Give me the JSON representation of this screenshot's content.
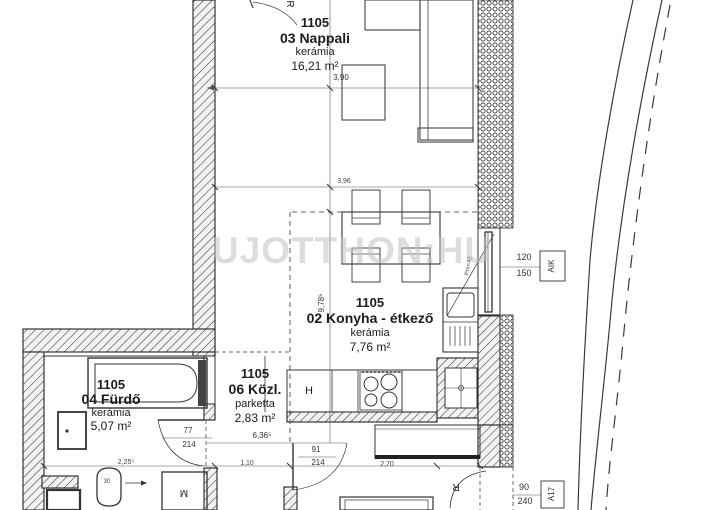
{
  "watermark": "UJOTTHON:HU",
  "rooms": {
    "nappali": {
      "unit": "1105",
      "name": "03 Nappali",
      "floor": "kerámia",
      "area": "16,21 m²"
    },
    "konyha": {
      "unit": "1105",
      "name": "02 Konyha - étkező",
      "floor": "kerámia",
      "area": "7,76 m²"
    },
    "furdo": {
      "unit": "1105",
      "name": "04 Fürdő",
      "floor": "kerámia",
      "area": "5,07 m²"
    },
    "kozl": {
      "unit": "1105",
      "name": "06 Közl.",
      "floor": "parketta",
      "area": "2,83 m²"
    }
  },
  "dimensions": {
    "living_width": "3,90",
    "kitchen_width": "3,96",
    "flat_length": "9,78⁵",
    "hall_length": "6,36⁵",
    "bath_width": "2,25⁵",
    "hall_width": "1,10",
    "kitchen_depth": "2,70",
    "toilet_offset": "30",
    "bath_door_width": "77",
    "bath_door_height": "214",
    "hall_door_width": "91",
    "hall_door_height": "214",
    "window_width": "120",
    "window_sill": "150",
    "window_code": "AIK",
    "entry_door_width": "90",
    "entry_door_height": "240",
    "entry_door_code": "A17"
  },
  "fixtures": {
    "fridge": "H",
    "washing_machine": "M",
    "radiator_top": "R",
    "radiator_bottom": "R",
    "parapet_note": "Pm=48"
  },
  "colors": {
    "line": "#2b2b2b",
    "watermark": "#c3c3c3",
    "background": "#ffffff"
  }
}
